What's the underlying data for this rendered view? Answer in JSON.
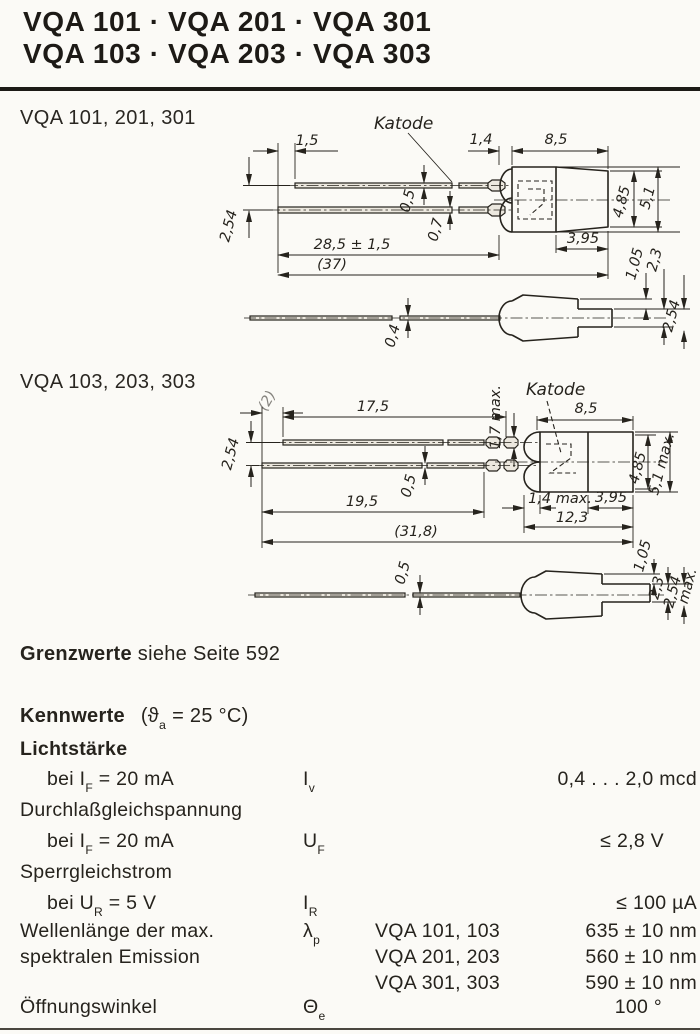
{
  "header": {
    "line1": "VQA 101 · VQA 201 · VQA 301",
    "line2": "VQA 103 · VQA 203 · VQA 303"
  },
  "drawing1": {
    "title": "VQA 101, 201, 301",
    "katode": "Katode",
    "dims": {
      "lead_offset": "1,5",
      "pitch": "2,54",
      "bead": "1,4",
      "body": "8,5",
      "upper_lead": "0,5",
      "lower_lead": "0,7",
      "lead_length": "28,5 ± 1,5",
      "total": "(37)",
      "dia_face": "4,85",
      "dia_max": "5,1",
      "rear": "3,95",
      "step": "1,05",
      "tab": "2,3",
      "side_tab": "2,54",
      "side_lead": "0,4"
    }
  },
  "drawing2": {
    "title": "VQA 103, 203, 303",
    "katode": "Katode",
    "dims": {
      "lead_offset": "(2)",
      "upper_length": "17,5",
      "crimp": "1,7 max.",
      "body": "8,5",
      "pitch": "2,54",
      "lead": "0,5",
      "lower_length": "19,5",
      "dia_face": "4,85",
      "dia_max": "5,1 max.",
      "front": "1,4 max.",
      "rear": "3,95",
      "mid": "12,3",
      "total": "(31,8)",
      "side_lead": "0,5",
      "step": "1,05",
      "tab": "2,3",
      "side_tab": "2,54",
      "side_tab_suffix": "max."
    }
  },
  "grenzwerte": {
    "lead": "Grenzwerte",
    "rest": " siehe Seite 592"
  },
  "kennwerte": {
    "title": "Kennwerte",
    "cond_pre": "(ϑ",
    "cond_sub": "a",
    "cond_post": " = 25 °C)",
    "rows": [
      {
        "label": "Lichtstärke"
      },
      {
        "pre": "bei I",
        "sub": "F",
        "post": " = 20 mA",
        "sym": "I",
        "symsub": "v",
        "value": "0,4 . . . 2,0 mcd"
      },
      {
        "label": "Durchlaßgleichspannung"
      },
      {
        "pre": "bei I",
        "sub": "F",
        "post": " = 20 mA",
        "sym": "U",
        "symsub": "F",
        "value": "≤ 2,8 V"
      },
      {
        "label": "Sperrgleichstrom"
      },
      {
        "pre": "bei U",
        "sub": "R",
        "post": " = 5 V",
        "sym": "I",
        "symsub": "R",
        "value": "≤ 100 µA"
      },
      {
        "label_line1": "Wellenlänge der max.",
        "label_line2": "spektralen Emission",
        "sym": "λ",
        "symsub": "p",
        "variants": [
          {
            "name": "VQA 101, 103",
            "value": "635 ± 10 nm"
          },
          {
            "name": "VQA 201, 203",
            "value": "560 ± 10 nm"
          },
          {
            "name": "VQA 301, 303",
            "value": "590 ± 10 nm"
          }
        ]
      },
      {
        "label": "Öffnungswinkel",
        "sym": "Θ",
        "symsub": "e",
        "value": "100 °"
      }
    ]
  }
}
